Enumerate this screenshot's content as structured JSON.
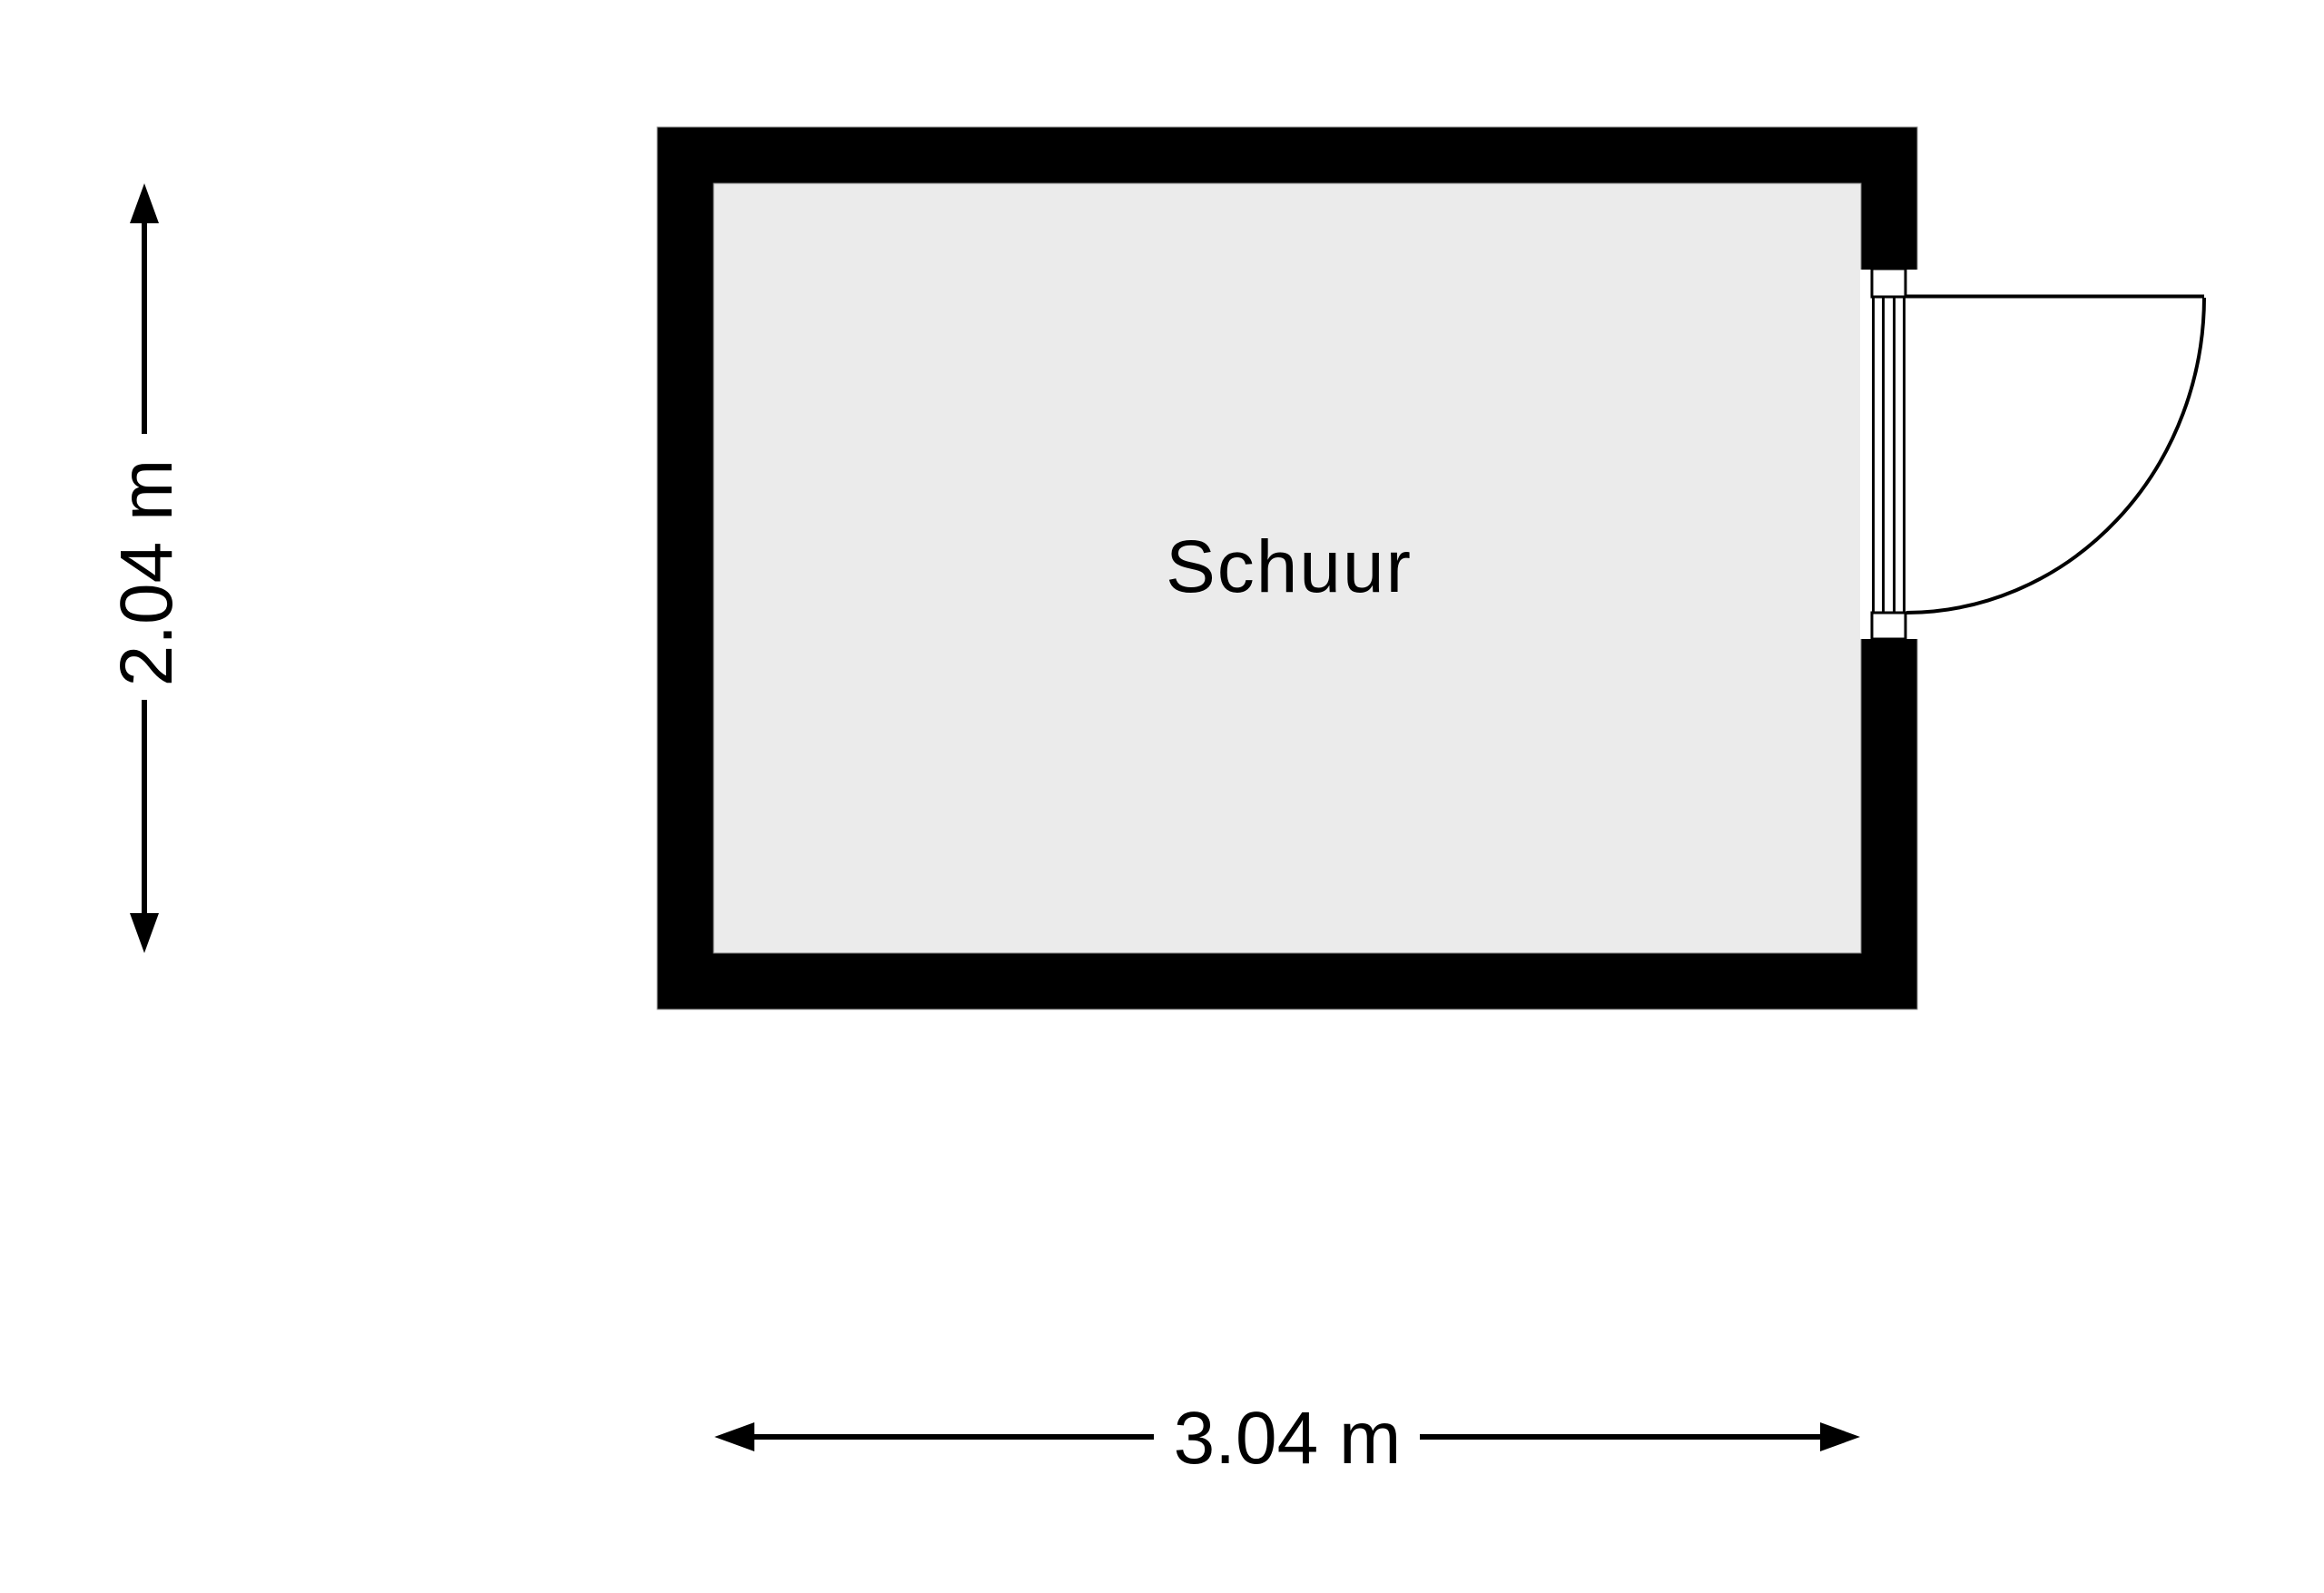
{
  "room": {
    "name": "Schuur"
  },
  "dimensions": {
    "vertical_label": "2.04 m",
    "horizontal_label": "3.04 m"
  },
  "colors": {
    "wall": "#000000",
    "floor": "#ebebeb",
    "background": "#ffffff",
    "text": "#000000"
  },
  "door": {
    "symbol": "door-swing-icon",
    "location": "right-wall",
    "swing": "outward"
  }
}
